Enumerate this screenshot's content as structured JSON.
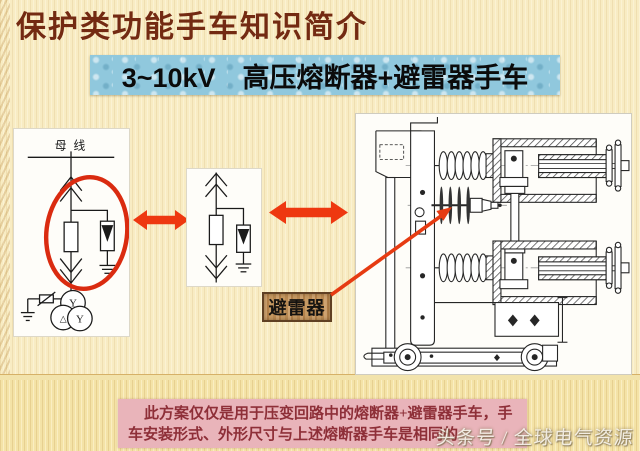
{
  "slide": {
    "title": "保护类功能手车知识简介",
    "banner": "3~10kV　高压熔断器+避雷器手车"
  },
  "diagrams": {
    "busbar_label": "母 线",
    "transformer": {
      "top": "Y",
      "bottom_left": "△",
      "bottom_right": "Y"
    },
    "arrester_label": "避雷器"
  },
  "note": {
    "line1": "此方案仅仅是用于压变回路中的熔断器+避雷器手车，手",
    "line2": "车安装形式、外形尺寸与上述熔断器手车是相同的"
  },
  "watermark": "头条号 / 全球电气资源",
  "colors": {
    "accent_red": "#ee3810",
    "highlight_red": "#da2b10",
    "title_maroon": "#732a12",
    "banner_blue": "#90c8dd",
    "note_pink": "#e9b4ba",
    "note_text": "#8e2f38",
    "wood_tan": "#c69a63",
    "background_cream": "#f8ecc3"
  }
}
